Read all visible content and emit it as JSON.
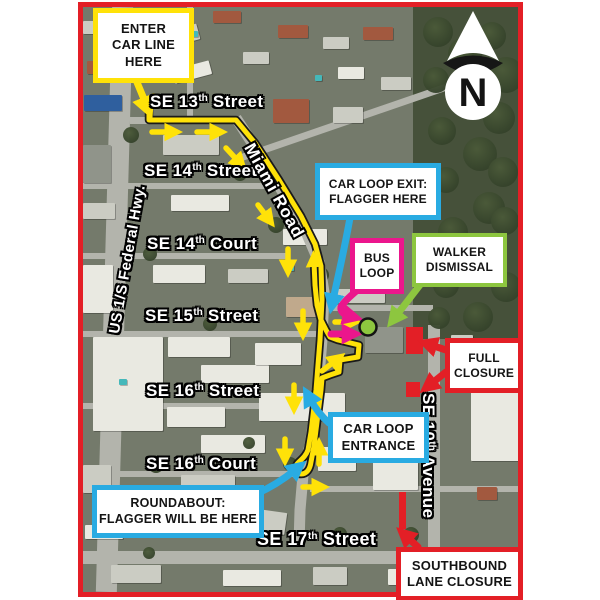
{
  "page": {
    "background": "#ffffff"
  },
  "colors": {
    "map_border_red": "#E31F26",
    "route_yellow": "#FFE208",
    "annotation_blue": "#29ABE2",
    "annotation_magenta": "#EB168C",
    "annotation_green": "#8DC63F",
    "annotation_red": "#E31F26"
  },
  "map": {
    "compass": {
      "label": "N"
    },
    "street_labels": {
      "se13": {
        "pre": "SE 13",
        "sup": "th",
        "post": " Street"
      },
      "se14st": {
        "pre": "SE 14",
        "sup": "th",
        "post": " Street"
      },
      "se14ct": {
        "pre": "SE 14",
        "sup": "th",
        "post": " Court"
      },
      "se15st": {
        "pre": "SE 15",
        "sup": "th",
        "post": " Street"
      },
      "se16st": {
        "pre": "SE 16",
        "sup": "th",
        "post": " Street"
      },
      "se16ct": {
        "pre": "SE 16",
        "sup": "th",
        "post": " Court"
      },
      "se17st": {
        "pre": "SE 17",
        "sup": "th",
        "post": " Street"
      },
      "se10ave": {
        "pre": "SE 10",
        "sup": "th",
        "post": " Avenue"
      },
      "miami_road": {
        "pre": "Miami Road",
        "sup": "",
        "post": ""
      },
      "us1": {
        "pre": "US 1/S Federal Hwy.",
        "sup": "",
        "post": ""
      }
    },
    "callouts": {
      "enter_car_line": {
        "accent": "#FFE208",
        "lines": [
          "ENTER",
          "CAR LINE",
          "HERE"
        ]
      },
      "car_loop_exit": {
        "accent": "#29ABE2",
        "lines": [
          "CAR LOOP EXIT:",
          "FLAGGER HERE"
        ]
      },
      "bus_loop": {
        "accent": "#EB168C",
        "lines": [
          "BUS",
          "LOOP"
        ]
      },
      "walker_dismissal": {
        "accent": "#8DC63F",
        "lines": [
          "WALKER",
          "DISMISSAL"
        ]
      },
      "full_closure": {
        "accent": "#E31F26",
        "lines": [
          "FULL",
          "CLOSURE"
        ]
      },
      "car_loop_entrance": {
        "accent": "#29ABE2",
        "lines": [
          "CAR LOOP",
          "ENTRANCE"
        ]
      },
      "roundabout": {
        "accent": "#29ABE2",
        "lines": [
          "ROUNDABOUT:",
          "FLAGGER WILL BE HERE"
        ]
      },
      "southbound_lane_closure": {
        "accent": "#E31F26",
        "lines": [
          "SOUTHBOUND",
          "LANE CLOSURE"
        ]
      }
    }
  }
}
